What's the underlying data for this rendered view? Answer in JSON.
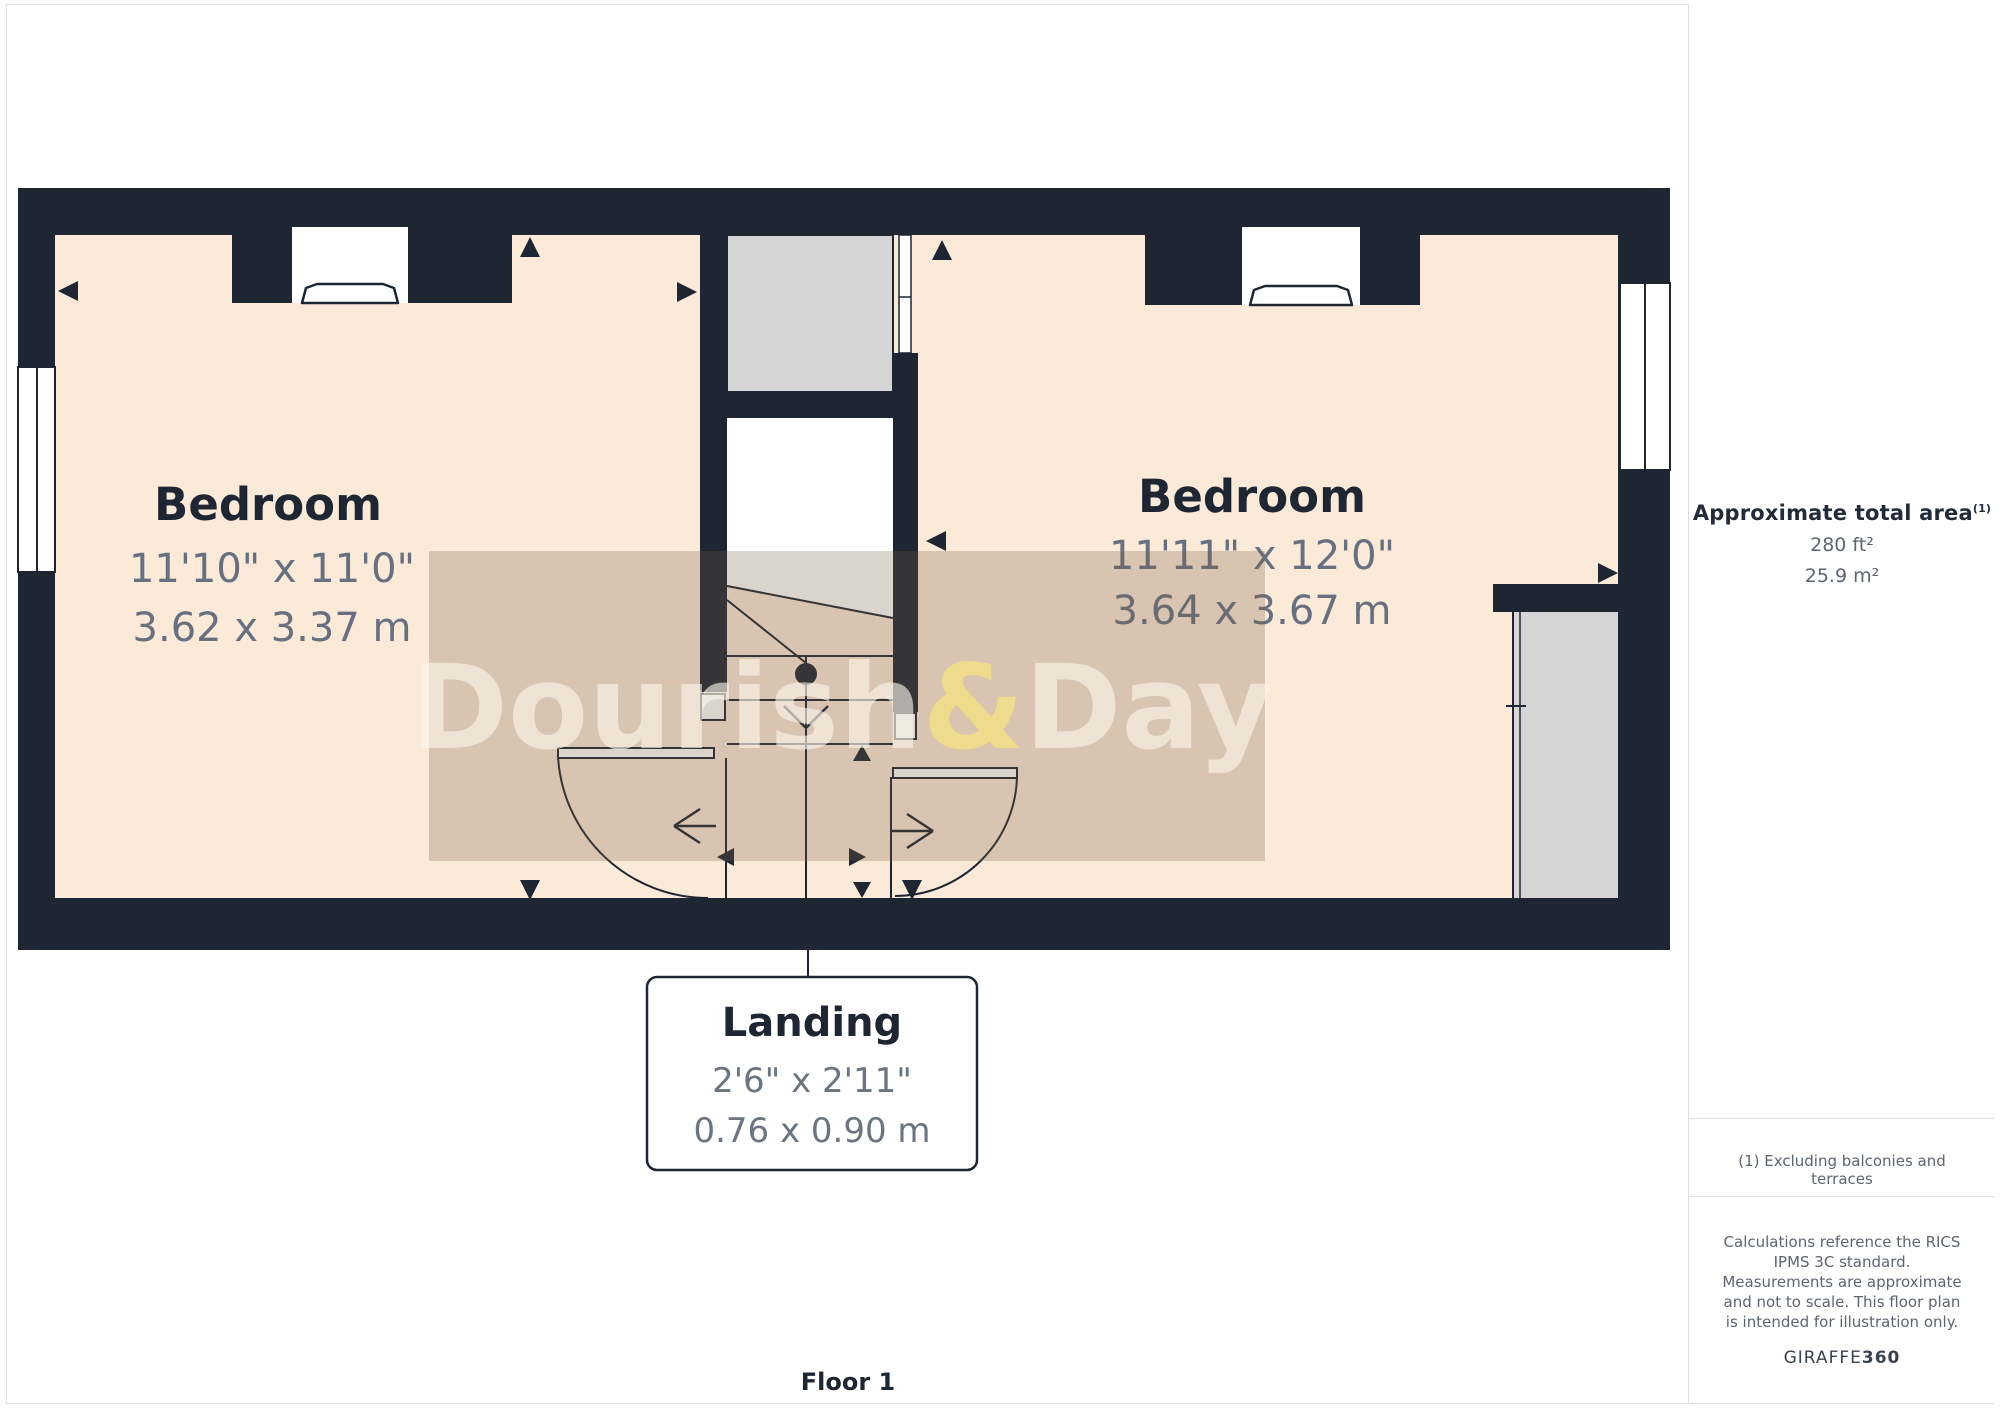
{
  "plan": {
    "rooms": [
      {
        "name": "Bedroom",
        "imperial": "11'10\" x 11'0\"",
        "metric": "3.62 x 3.37 m"
      },
      {
        "name": "Bedroom",
        "imperial": "11'11\" x 12'0\"",
        "metric": "3.64 x 3.67 m"
      }
    ],
    "callout": {
      "name": "Landing",
      "imperial": "2'6\" x 2'11\"",
      "metric": "0.76 x 0.90 m"
    },
    "floor_label": "Floor 1",
    "watermark": {
      "text_left": "Dourish",
      "ampersand": "&",
      "text_right": "Day"
    },
    "colors": {
      "wall": "#1e2634",
      "room_fill": "#fcead8",
      "void_gray": "#d6d6d6",
      "dim_text": "#667080",
      "watermark_tint": "rgba(120,95,70,0.27)",
      "watermark_letters": "rgba(252,246,234,0.62)",
      "watermark_ampersand": "rgba(250,232,120,0.65)"
    }
  },
  "sidebar": {
    "area_title": "Approximate total area",
    "area_sup": "(1)",
    "area_imperial": "280 ft²",
    "area_metric": "25.9 m²",
    "footnote": "(1) Excluding balconies and terraces",
    "disclaimer": "Calculations reference the RICS IPMS 3C standard. Measurements are approximate and not to scale. This floor plan is intended for illustration only.",
    "brand_name": "GIRAFFE",
    "brand_number": "360"
  }
}
